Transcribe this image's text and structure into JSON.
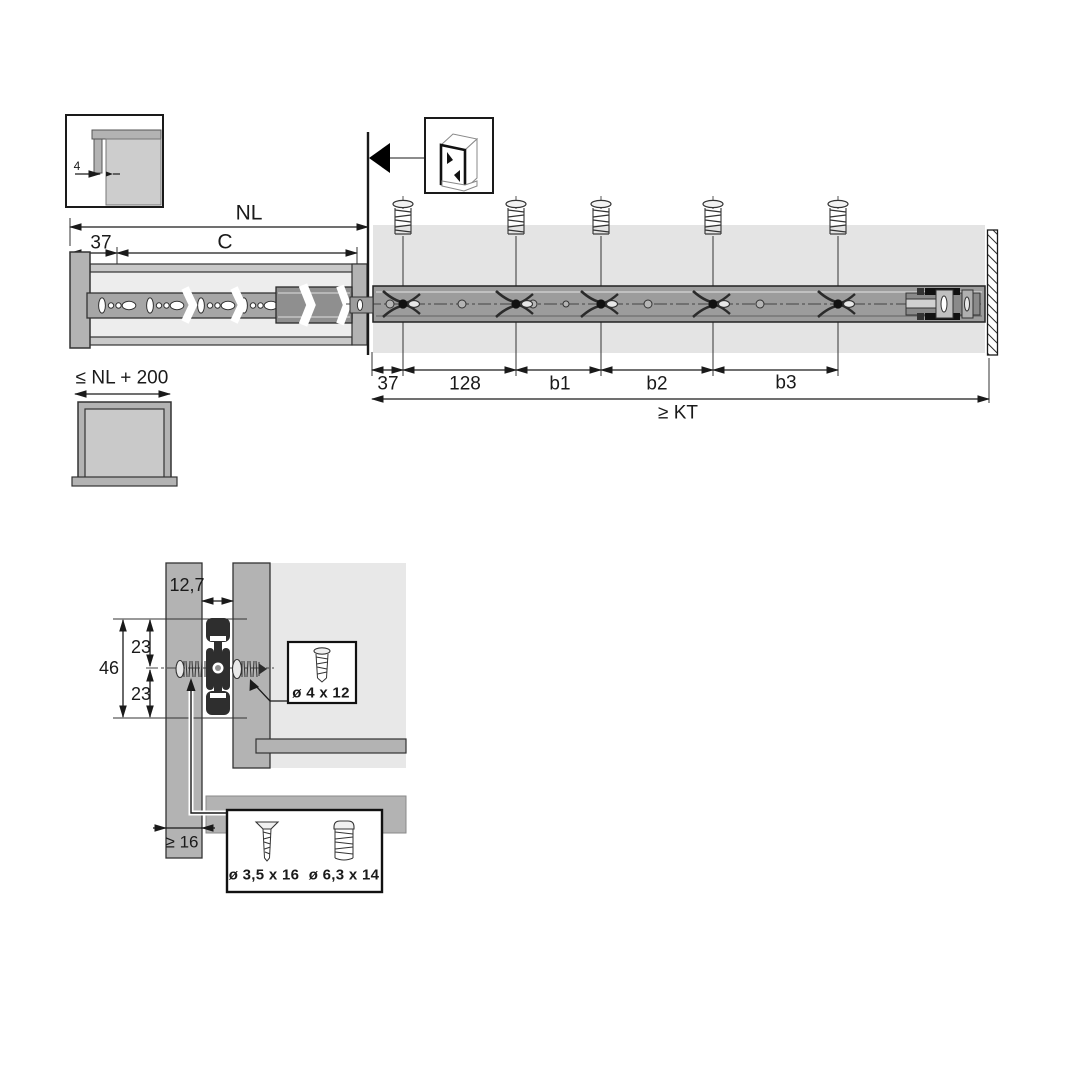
{
  "title": "drawer-runner-installation-drawing",
  "colors": {
    "outline": "#1a1a1a",
    "panel_gray": "#b3b3b3",
    "light_panel": "#ededed",
    "cabinet_band": "#e4e4e4",
    "rail_gray": "#9c9c9c",
    "profile_dark": "#2e2e2e"
  },
  "inset_detail": {
    "front_gap": "4"
  },
  "main_view": {
    "nl": "NL",
    "c": "C",
    "front_offset": "37",
    "bottom_dims": [
      "37",
      "128",
      "b1",
      "b2",
      "b3"
    ],
    "kt": "≥ KT"
  },
  "front_view": {
    "max_width": "≤ NL + 200"
  },
  "section_view": {
    "panel_gap": "12,7",
    "height_total": "46",
    "height_top": "23",
    "height_bottom": "23",
    "min_thickness": "≥ 16",
    "side_screw": "ø 4 x 12",
    "bottom_screw_1": "ø 3,5 x 16",
    "bottom_screw_2": "ø 6,3 x 14"
  },
  "icons": {
    "cabinet_icon": "cabinet-front-assembly-icon",
    "detach_arrow": "front-direction-arrow",
    "screw_icon": "mounting-screw",
    "wall": "rear-wall-hatch"
  }
}
